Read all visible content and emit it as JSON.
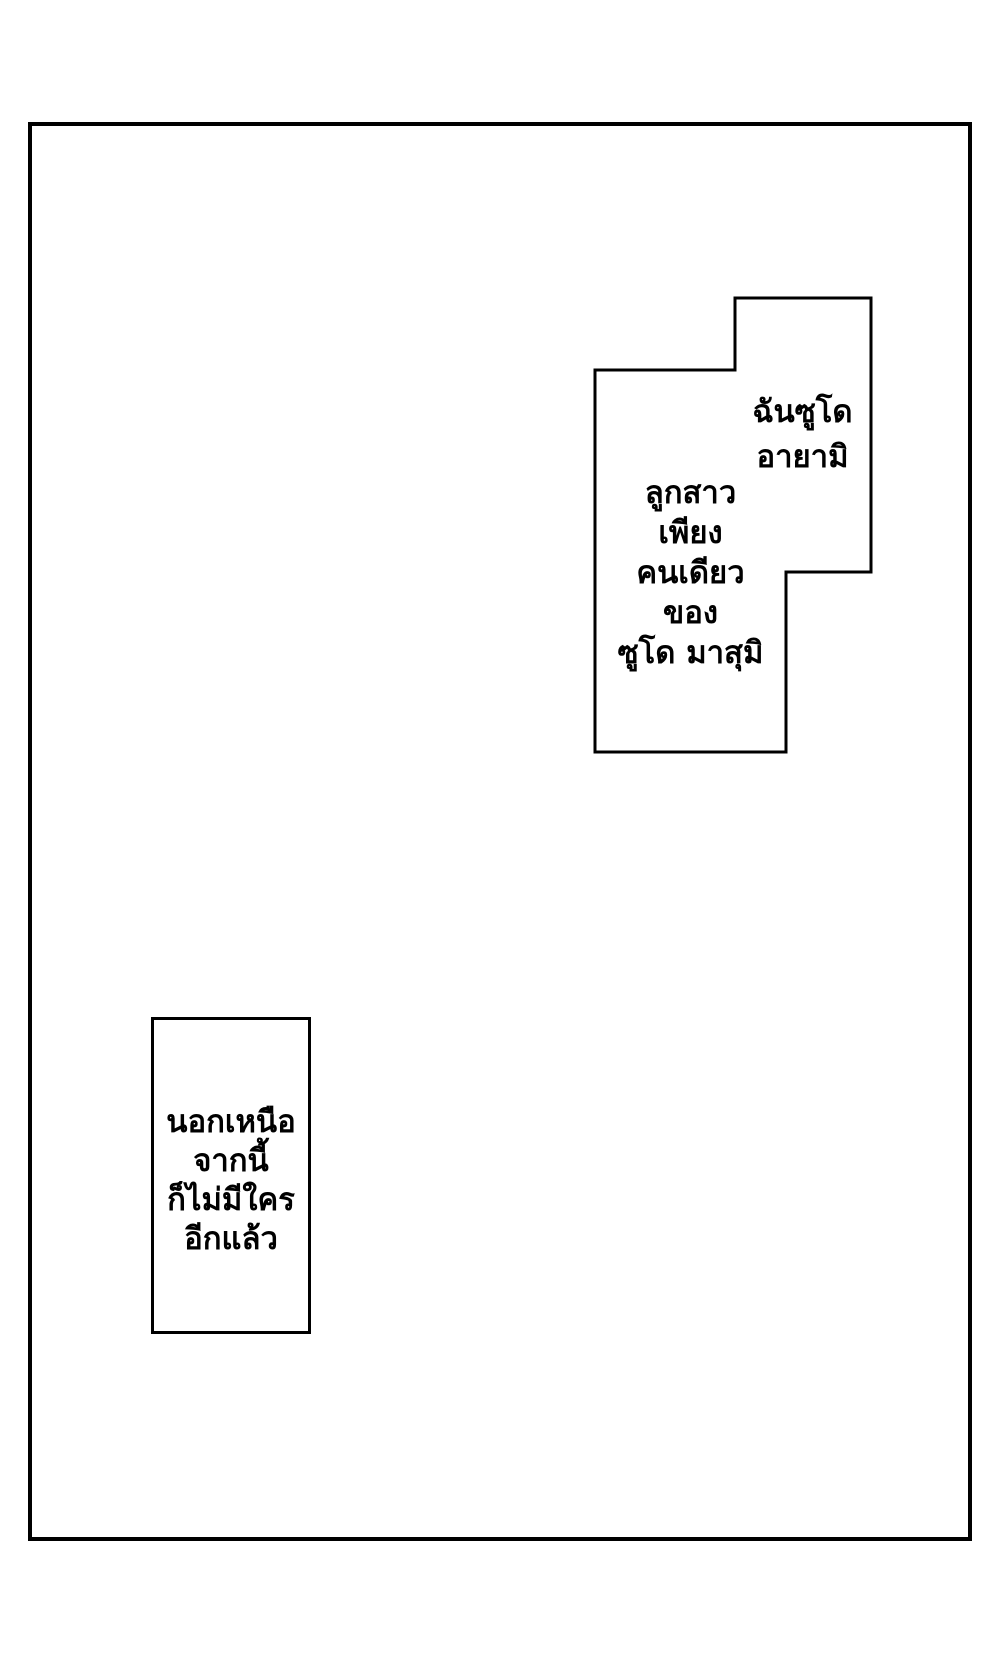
{
  "page": {
    "background_color": "#ffffff",
    "ink_color": "#000000"
  },
  "top_balloon": {
    "intro_lines": [
      "ฉันซูโด",
      "อายามิ"
    ],
    "detail_lines": [
      "ลูกสาว",
      "เพียง",
      "คนเดียว",
      "ของ",
      "ซูโด มาสุมิ"
    ]
  },
  "bottom_caption": {
    "lines": [
      "นอกเหนือ",
      "จากนี้",
      "ก็ไม่มีใคร",
      "อีกแล้ว"
    ]
  }
}
